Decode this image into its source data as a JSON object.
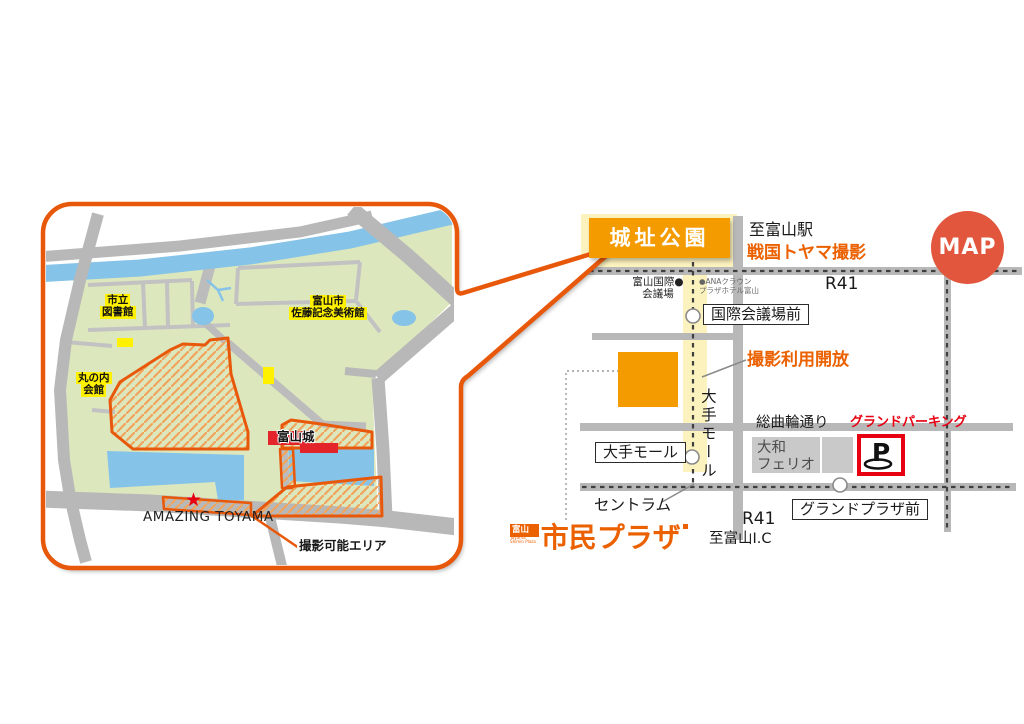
{
  "colors": {
    "orange_border": "#E8580A",
    "orange_box": "#F49B00",
    "map_badge_bg": "#E2563D",
    "accent_red": "#E60012",
    "road_gray": "#B8B8B8",
    "park_green": "#DCE7BD",
    "water_blue": "#85C3E8",
    "highlight_yellow": "#FCF2BE",
    "label_yellow": "#FFF100",
    "logo_orange": "#EB6100"
  },
  "map_badge": {
    "label": "MAP"
  },
  "right_map": {
    "park_box": "城址公園",
    "to_station": "至富山駅",
    "sengoku_note": "戦国トヤマ撮影",
    "route_top": "R41",
    "intl_center_l1": "富山国際●",
    "intl_center_l2": "会議場",
    "hotel_l1": "●ANAクラウン",
    "hotel_l2": "プラザホテル富山",
    "stop_kokusai": "国際会議場前",
    "open_note": "撮影利用開放",
    "otemall_street": "大手モール",
    "stop_otemall": "大手モール",
    "sogawa_street": "総曲輪通り",
    "grand_parking": "グランドパーキング",
    "daiwa_l1": "大和",
    "daiwa_l2": "フェリオ",
    "parking_p": "P",
    "centram": "セントラム",
    "stop_grand_plaza": "グランドプラザ前",
    "route_bottom": "R41",
    "to_ic": "至富山I.C"
  },
  "logo": {
    "prefix": "富山",
    "sub_l1": "Toyama",
    "sub_l2": "Shimin Plaza",
    "name": "市民プラザ"
  },
  "left_map": {
    "library_l1": "市立",
    "library_l2": "図書館",
    "museum_l1": "富山市",
    "museum_l2": "佐藤記念美術館",
    "hall_l1": "丸の内",
    "hall_l2": "会館",
    "castle": "富山城",
    "amazing": "AMAZING TOYAMA",
    "star": "★",
    "shoot_area": "撮影可能エリア"
  }
}
